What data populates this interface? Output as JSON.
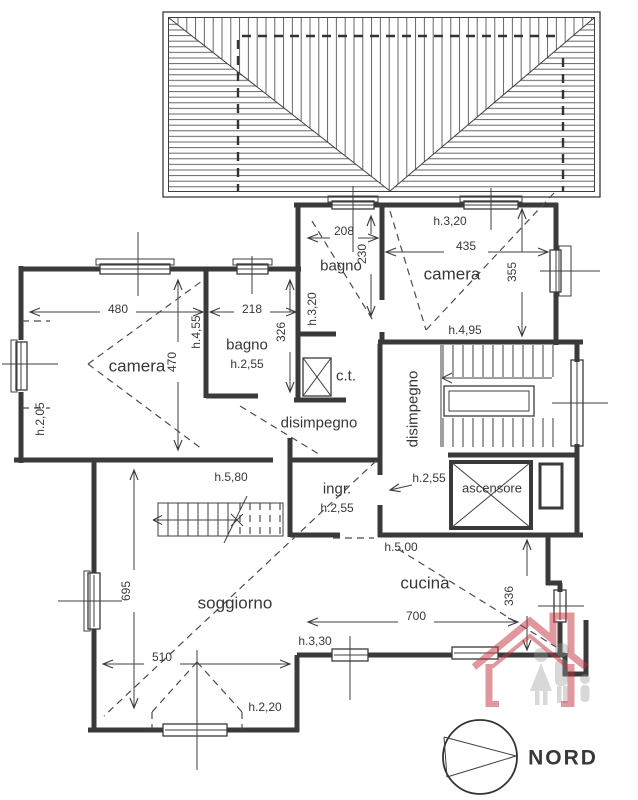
{
  "drawing": {
    "type": "apartment floor plan (attic level)",
    "language": "Italian"
  },
  "labels": {
    "dim_480": "480",
    "dim_218": "218",
    "h_4_55": "h.4,55",
    "dim_470": "470",
    "camera_sx": "camera",
    "bagno_sx": "bagno",
    "h_bagno_sx": "h.2,55",
    "dim_326": "326",
    "h_2_05": "h.2,05",
    "h_3_20_bagno": "h.3,20",
    "dim_208": "208",
    "dim_230": "230",
    "bagno_c": "bagno",
    "h_3_20_camera": "h.3,20",
    "dim_435": "435",
    "camera_dx": "camera",
    "h_4_95": "h.4,95",
    "dim_355": "355",
    "ct": "c.t.",
    "disimpegno_c": "disimpegno",
    "disimpegno_dx": "disimpegno",
    "ingr": "ingr.",
    "h_ingr": "h.2,55",
    "h_disimpegno_dx": "h.2,55",
    "ascensore": "ascensore",
    "h_5_80": "h.5,80",
    "dim_695": "695",
    "soggiorno": "soggiorno",
    "dim_510": "510",
    "h_2_20": "h.2,20",
    "h_3_30": "h.3,30",
    "h_5_00": "h.5,00",
    "cucina": "cucina",
    "dim_336": "336",
    "dim_700": "700",
    "nord": "NORD"
  },
  "colors": {
    "line": "#3a3a3a",
    "dashed": "#4c4c4c",
    "logo_red": "#c23440",
    "logo_gray": "#9a9a9a",
    "background": "#ffffff"
  }
}
